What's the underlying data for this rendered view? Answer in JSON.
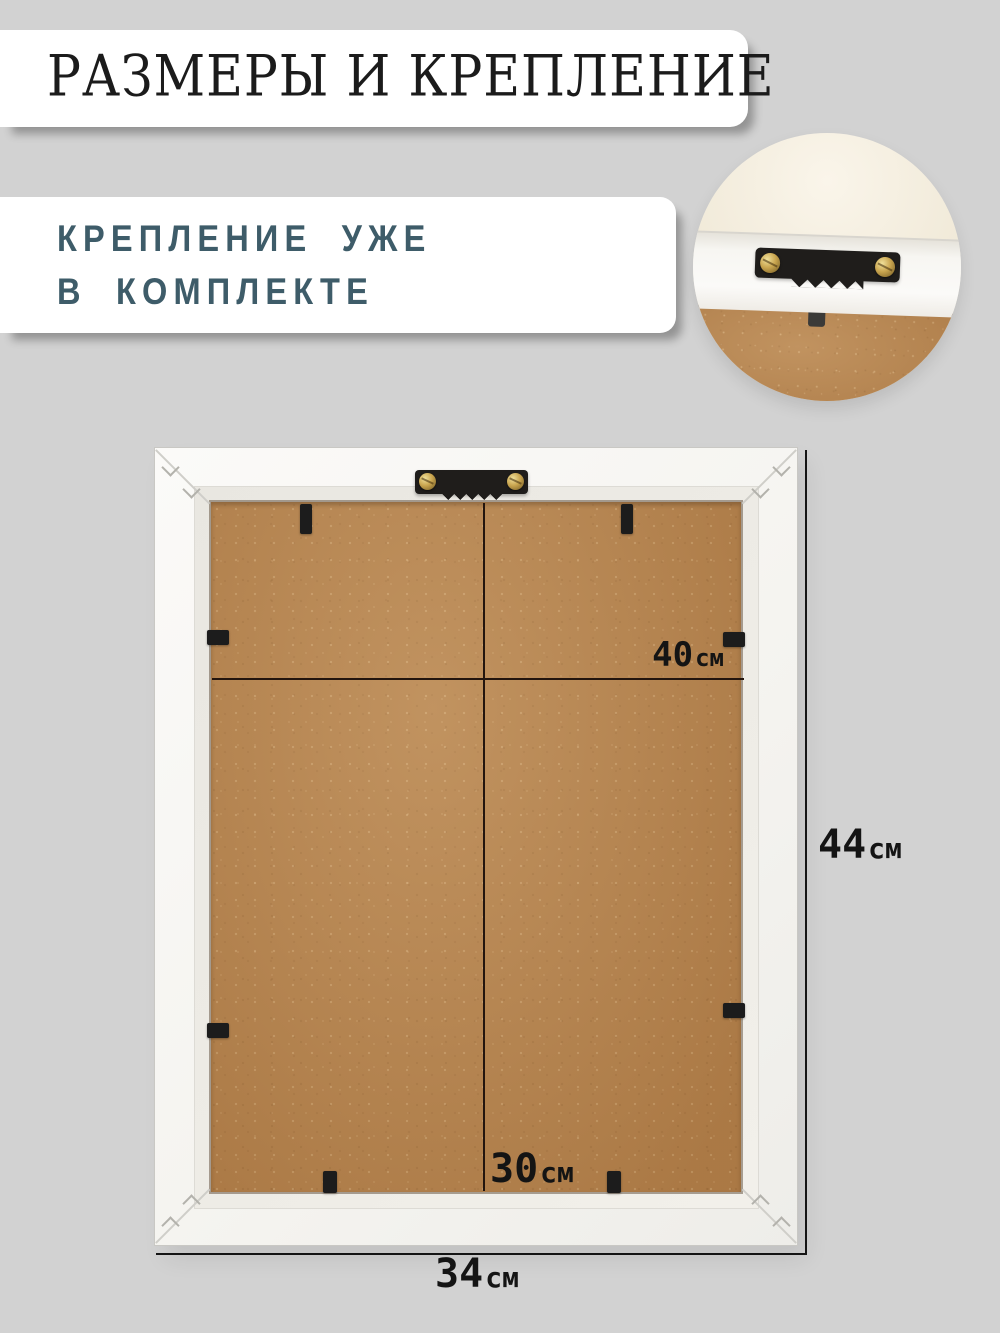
{
  "header": {
    "title": "РАЗМЕРЫ И КРЕПЛЕНИЕ"
  },
  "callout": {
    "line1": "КРЕПЛЕНИЕ УЖЕ",
    "line2": "В КОМПЛЕКТЕ"
  },
  "dimensions": {
    "inner_width": {
      "value": "40",
      "unit": "см"
    },
    "outer_height": {
      "value": "44",
      "unit": "см"
    },
    "inner_height": {
      "value": "30",
      "unit": "см"
    },
    "outer_width": {
      "value": "34",
      "unit": "см"
    }
  },
  "colors": {
    "background": "#d2d2d2",
    "banner": "#ffffff",
    "title_text": "#1b1b1b",
    "callout_text": "#3e5c69",
    "dimension_text": "#141414",
    "dimension_line": "#23150e",
    "frame_white": "#f7f6f3",
    "mdf_brown": "#b5814a",
    "hanger_black": "#1f1d1b",
    "screw_brass": "#c9a54f"
  }
}
